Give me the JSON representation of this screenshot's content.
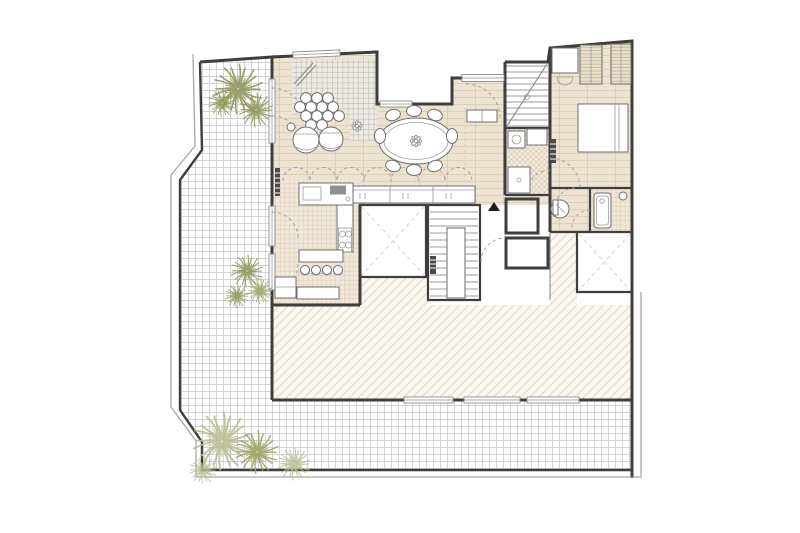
{
  "canvas": {
    "viewBox": "0 0 800 533",
    "width": 800,
    "height": 533,
    "background": "#ffffff"
  },
  "colors": {
    "wall": "#3e3e3e",
    "wallLight": "#a8a8a8",
    "wood": "#ece3d1",
    "woodLine": "#d8cab1",
    "kitchenTile": "#f1e8da",
    "kitchenTileLine": "#dccfb8",
    "mosaicTile": "#edebe5",
    "mosaicLine": "#bcb8ae",
    "terraceTile": "#ffffff",
    "terraceLine": "#c6c6c6",
    "hatchBg": "#faf7f0",
    "hatchLine": "#ded3c0",
    "bathTile": "#f2ebdd",
    "bathLine": "#cebfa2",
    "wardrobeBg": "#e9e0cc",
    "wardrobeLine": "#b9ad92",
    "fixture": "#ffffff",
    "furnLine": "#6e6e6e",
    "dashLine": "#9c9c9c",
    "plantDark": "#8e9459",
    "plantMid": "#9aa061",
    "plantLight": "#b9bd92",
    "marker": "#1c1c1c",
    "radiator": "#4a4a4a"
  },
  "plan": {
    "type": "architectural-floor-plan",
    "visible_text": "",
    "elements": [
      {
        "name": "terrace",
        "floor": "grid-tile",
        "shape": "L-wrap-left-and-bottom"
      },
      {
        "name": "living-area",
        "floor": "wood-plank"
      },
      {
        "name": "mosaic-corner",
        "floor": "small-grid-tile"
      },
      {
        "name": "dining-area",
        "floor": "wood-plank",
        "table": "oval",
        "chairs": 8
      },
      {
        "name": "kitchen",
        "floor": "ceramic-tile",
        "bar_stools": 4,
        "cooktop_burners": 4
      },
      {
        "name": "entry-hall",
        "floor": "wood-plank"
      },
      {
        "name": "interior-bathroom",
        "floor": "cross-hatch-tile"
      },
      {
        "name": "bedroom",
        "floor": "wood-plank",
        "wardrobes": 2,
        "bed": 1,
        "desk": 1
      },
      {
        "name": "wc",
        "toilet": 1
      },
      {
        "name": "ensuite-bathroom",
        "floor": "grid-tile",
        "shower_tray": 1
      },
      {
        "name": "main-staircase",
        "treads": 13
      },
      {
        "name": "entry-staircase",
        "treads": 11
      },
      {
        "name": "lightwell",
        "count": 2,
        "marking": "dashed-X"
      },
      {
        "name": "roof-hatch-area",
        "marking": "diagonal-hatch"
      },
      {
        "name": "plants",
        "clusters": 3,
        "shrubs": 10
      },
      {
        "name": "armchairs",
        "count": 2
      },
      {
        "name": "pouf-cluster",
        "circles": 13
      },
      {
        "name": "sideboard",
        "sections": 3
      },
      {
        "name": "radiators",
        "count": 3
      },
      {
        "name": "entrance-marker",
        "glyph": "triangle-up"
      }
    ]
  }
}
